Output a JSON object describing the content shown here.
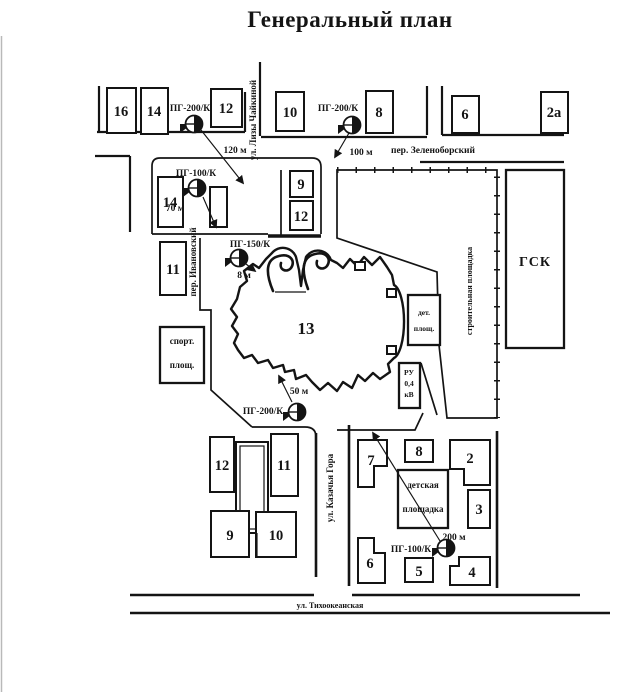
{
  "title": "Генеральный план",
  "colors": {
    "ink": "#141414",
    "paper": "#ffffff"
  },
  "streets": {
    "zelenoborsky": "пер. Зеленоборский",
    "chaykina": "ул. Лизы Чайкиной",
    "ivanovsky": "пер. Ивановский",
    "kazachya": "ул. Казачья Гора",
    "tikhookeanskaya": "ул. Тихоокеанская"
  },
  "hydrants": [
    {
      "label": "ПГ-200/К",
      "distance": "120 м"
    },
    {
      "label": "ПГ-200/К",
      "distance": "100 м"
    },
    {
      "label": "ПГ-100/К",
      "distance": "70 м"
    },
    {
      "label": "ПГ-150/К",
      "distance": "8 м"
    },
    {
      "label": "ПГ-200/К",
      "distance": "50 м"
    },
    {
      "label": "ПГ-100/К",
      "distance": "200 м"
    }
  ],
  "buildings": {
    "top_row": {
      "b16": "16",
      "b14": "14",
      "b12": "12",
      "b10": "10",
      "b8": "8",
      "b6": "6",
      "b2a": "2а"
    },
    "mid": {
      "b14": "14",
      "b9": "9",
      "b12": "12",
      "b11": "11",
      "b13": "13",
      "gsk": "ГСК"
    },
    "bottom_left": {
      "b12": "12",
      "b11": "11",
      "b9": "9",
      "b10": "10"
    },
    "bottom_right": {
      "b7": "7",
      "b8": "8",
      "b2": "2",
      "b3": "3",
      "b6": "6",
      "b5": "5",
      "b4": "4"
    }
  },
  "areas": {
    "sport": {
      "line1": "спорт.",
      "line2": "площ."
    },
    "det": {
      "line1": "дет.",
      "line2": "площ."
    },
    "construction": "строительная площадка",
    "playground": {
      "line1": "детская",
      "line2": "площадка"
    },
    "ru": {
      "line1": "РУ",
      "line2": "0,4",
      "line3": "кВ"
    }
  }
}
